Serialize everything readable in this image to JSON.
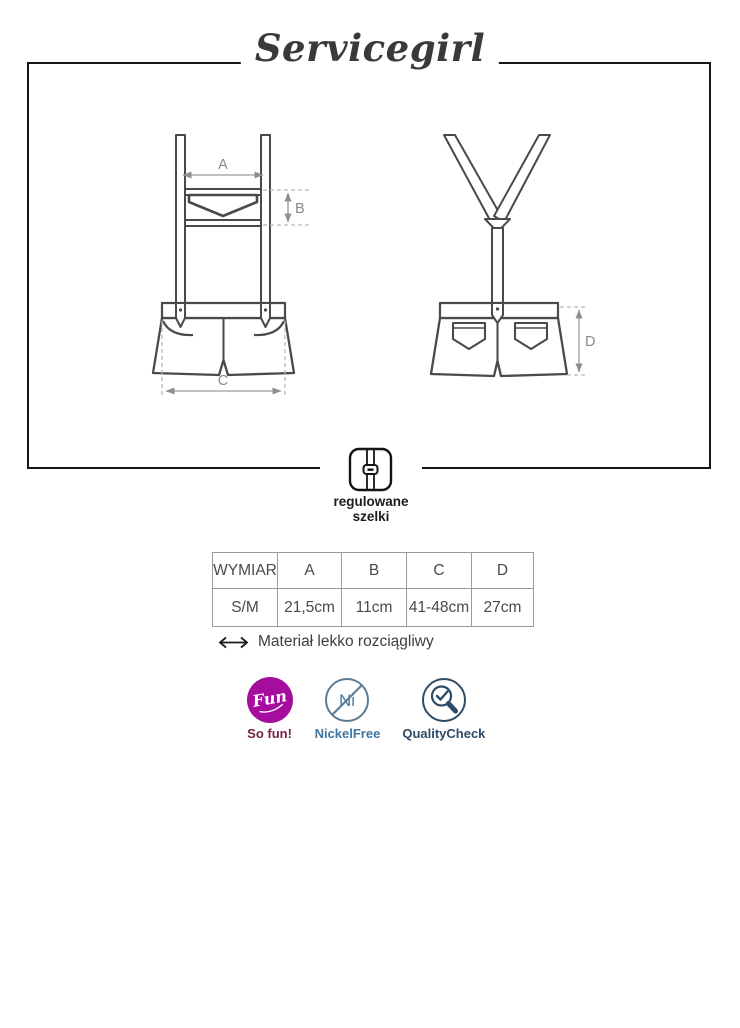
{
  "brand": {
    "title": "Servicegirl"
  },
  "diagram": {
    "views": [
      "front",
      "back"
    ],
    "dimension_labels": {
      "a": "A",
      "b": "B",
      "c": "C",
      "d": "D"
    },
    "feature": {
      "icon": "adjustable-suspenders-icon",
      "line1": "regulowane",
      "line2": "szelki"
    }
  },
  "size_table": {
    "headers": [
      "WYMIAR",
      "A",
      "B",
      "C",
      "D"
    ],
    "rows": [
      {
        "cells": [
          "S/M",
          "21,5cm",
          "11cm",
          "41-48cm",
          "27cm"
        ]
      }
    ]
  },
  "material_note": {
    "icon": "double-arrow-icon",
    "text": "Materiał lekko rozciągliwy"
  },
  "badges": [
    {
      "name": "fun",
      "circle_text": "Fun",
      "label": "So fun!"
    },
    {
      "name": "nickel-free",
      "circle_text": "Ni",
      "label": "NickelFree"
    },
    {
      "name": "quality-check",
      "label": "QualityCheck"
    }
  ],
  "colors": {
    "fun_circle": "#a60d9e",
    "so_fun_text": "#7a2148",
    "nickel_free_icon": "#5c7b92",
    "nickel_free_text": "#3f75a2",
    "quality_check": "#2d4a66",
    "garment_line": "#4a4a4a",
    "dimension_line": "#8f8f8f",
    "box_border": "#161616"
  }
}
